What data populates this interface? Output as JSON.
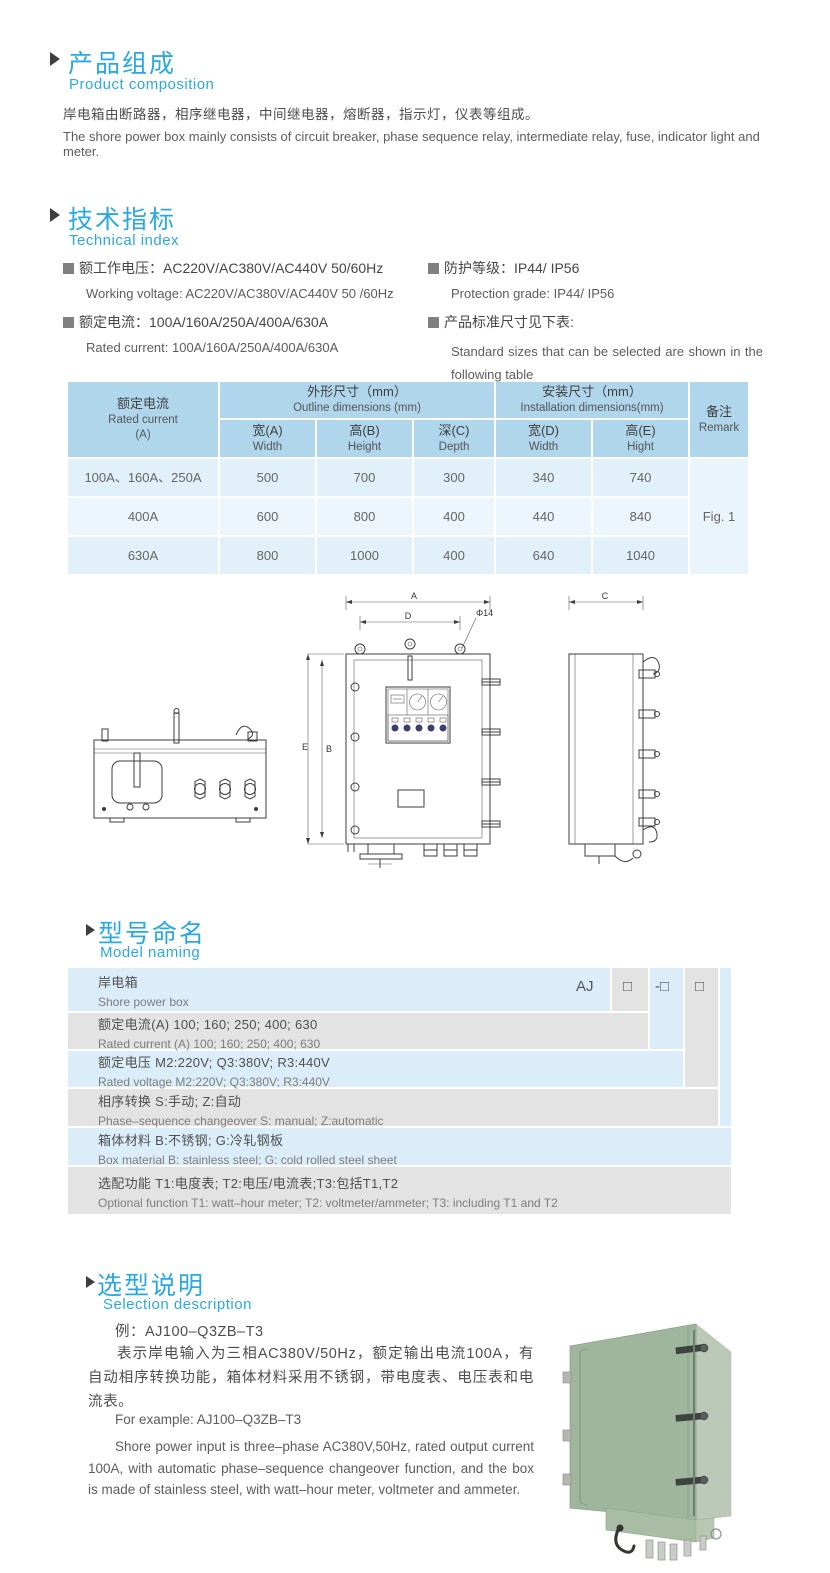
{
  "colors": {
    "accent_blue": "#2aa9e0",
    "table_header_bg": "#b0d6ec",
    "table_row_light": "#e2f0f9",
    "table_row_lighter": "#edf6fc",
    "naming_blue": "#dcedfa",
    "naming_gray": "#e3e3e4",
    "photo_green": "#9fb69c"
  },
  "product_composition": {
    "title_zh": "产品组成",
    "title_en": "Product  composition",
    "body_zh": "岸电箱由断路器，相序继电器，中间继电器，熔断器，指示灯，仪表等组成。",
    "body_en": "The shore power box mainly consists of circuit breaker, phase sequence relay, intermediate relay, fuse, indicator light and meter."
  },
  "technical_index": {
    "title_zh": "技术指标",
    "title_en": "Technical index",
    "specs": [
      {
        "zh": "额工作电压：AC220V/AC380V/AC440V  50/60Hz",
        "en": "Working voltage: AC220V/AC380V/AC440V 50 /60Hz"
      },
      {
        "zh": "额定电流：100A/160A/250A/400A/630A",
        "en": "Rated current: 100A/160A/250A/400A/630A"
      },
      {
        "zh": "防护等级：IP44/ IP56",
        "en": "Protection grade: IP44/ IP56"
      },
      {
        "zh": "产品标准尺寸见下表:",
        "en": "Standard sizes that can be selected are shown in the following table"
      }
    ]
  },
  "size_table": {
    "header": {
      "rated_current_zh": "额定电流",
      "rated_current_en": "Rated current",
      "rated_current_unit": "(A)",
      "outline_zh": "外形尺寸（mm）",
      "outline_en": "Outline dimensions (mm)",
      "install_zh": "安装尺寸（mm）",
      "install_en": "Installation dimensions(mm)",
      "remark_zh": "备注",
      "remark_en": "Remark",
      "sub": [
        {
          "zh": "宽(A)",
          "en": "Width"
        },
        {
          "zh": "高(B)",
          "en": "Height"
        },
        {
          "zh": "深(C)",
          "en": "Depth"
        },
        {
          "zh": "宽(D)",
          "en": "Width"
        },
        {
          "zh": "高(E)",
          "en": "Hight"
        }
      ]
    },
    "rows": [
      {
        "current": "100A、160A、250A",
        "values": [
          "500",
          "700",
          "300",
          "340",
          "740"
        ]
      },
      {
        "current": "400A",
        "values": [
          "600",
          "800",
          "400",
          "440",
          "840"
        ]
      },
      {
        "current": "630A",
        "values": [
          "800",
          "1000",
          "400",
          "640",
          "1040"
        ]
      }
    ],
    "remark_value": "Fig. 1"
  },
  "drawing_labels": {
    "dim_a": "A",
    "dim_d": "D",
    "hole": "Φ14",
    "dim_e": "E",
    "dim_b": "B",
    "dim_c": "C"
  },
  "model_naming": {
    "title_zh": "型号命名",
    "title_en": "Model naming",
    "code_parts": [
      "AJ",
      "□",
      "-□",
      "□"
    ],
    "rows": [
      {
        "zh": "岸电箱",
        "en": "Shore power box"
      },
      {
        "zh": "额定电流(A)  100; 160; 250; 400; 630",
        "en": "Rated current (A) 100; 160; 250; 400; 630"
      },
      {
        "zh": "额定电压   M2:220V;  Q3:380V;  R3:440V",
        "en": "Rated voltage  M2:220V;  Q3:380V;  R3:440V"
      },
      {
        "zh": "相序转换  S:手动; Z:自动",
        "en": "Phase–sequence changeover  S: manual;  Z:automatic"
      },
      {
        "zh": "箱体材料      B:不锈钢;  G:冷轧钢板",
        "en": "Box material    B: stainless steel; G: cold rolled steel sheet"
      },
      {
        "zh": "选配功能        T1:电度表;  T2:电压/电流表;T3:包括T1,T2",
        "en": "Optional function  T1: watt–hour meter; T2: voltmeter/ammeter; T3: including T1 and T2"
      }
    ]
  },
  "selection": {
    "title_zh": "选型说明",
    "title_en": "Selection description",
    "example_zh": "例：AJ100–Q3ZB–T3",
    "body_zh": "表示岸电输入为三相AC380V/50Hz，额定输出电流100A，有自动相序转换功能，箱体材料采用不锈钢，带电度表、电压表和电流表。",
    "example_en": "For example: AJ100–Q3ZB–T3",
    "body_en": "Shore power input is three–phase AC380V,50Hz, rated output current 100A, with automatic phase–sequence changeover function, and the box is made of stainless steel, with watt–hour meter, voltmeter and ammeter."
  }
}
